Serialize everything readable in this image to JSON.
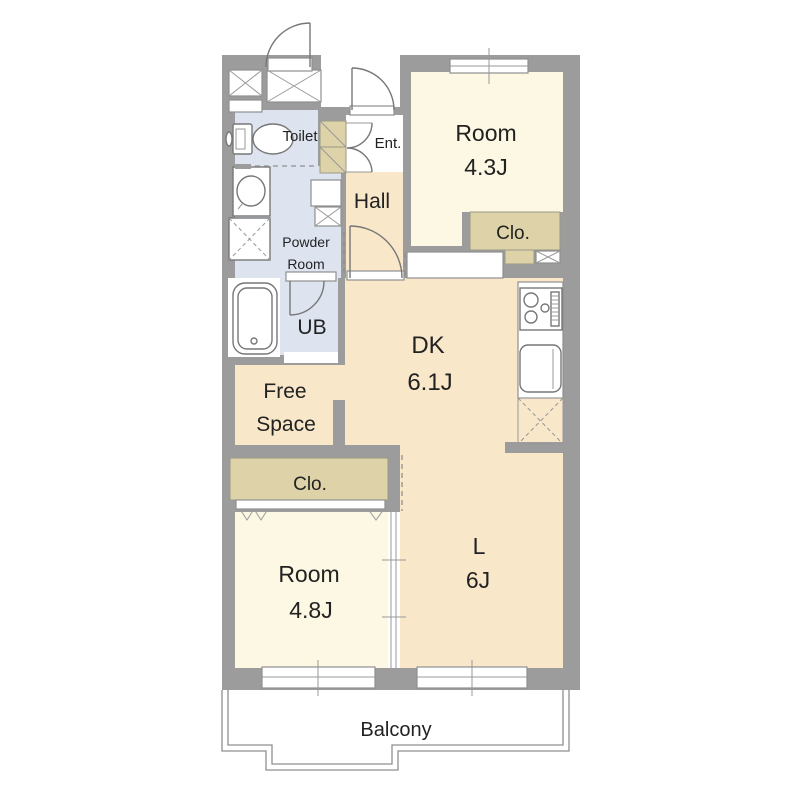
{
  "title": "Apartment floor plan",
  "colors": {
    "wall": "#9c9c9c",
    "room_cream": "#fcf8e3",
    "room_peach": "#f9e7ca",
    "room_blue": "#dde4f0",
    "closet_tan": "#ded2a8",
    "line": "#777777",
    "text": "#222222"
  },
  "rooms": {
    "room_43": {
      "label": "Room",
      "area": "4.3J"
    },
    "room_48": {
      "label": "Room",
      "area": "4.8J"
    },
    "dk": {
      "label": "DK",
      "area": "6.1J"
    },
    "living": {
      "label": "L",
      "area": "6J"
    },
    "hall": {
      "label": "Hall"
    },
    "entrance": {
      "label": "Ent."
    },
    "toilet": {
      "label": "Toilet"
    },
    "powder": {
      "line1": "Powder",
      "line2": "Room"
    },
    "ub": {
      "label": "UB"
    },
    "free_space": {
      "line1": "Free",
      "line2": "Space"
    },
    "closet_upper": {
      "label": "Clo."
    },
    "closet_lower": {
      "label": "Clo."
    },
    "balcony": {
      "label": "Balcony"
    }
  }
}
